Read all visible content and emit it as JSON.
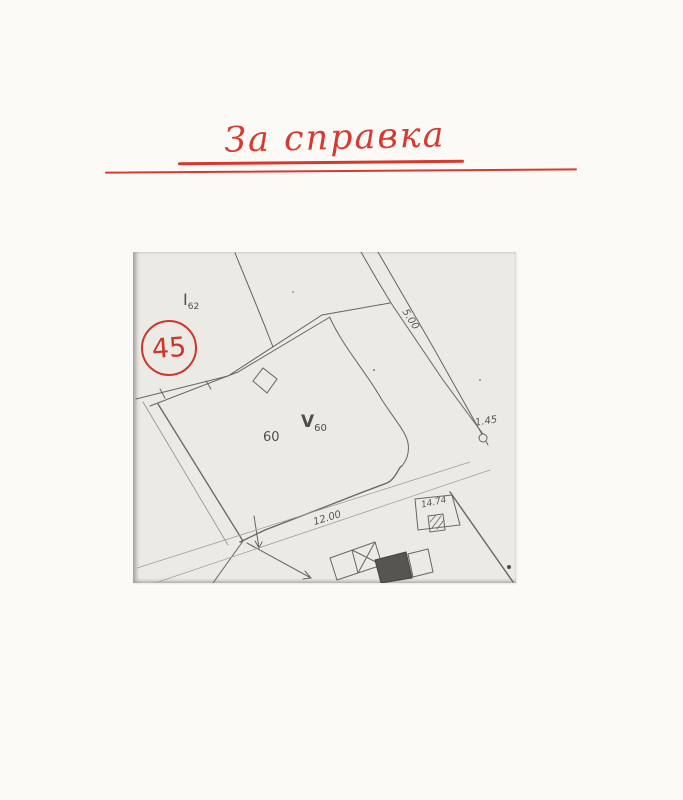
{
  "page": {
    "title": "За справка",
    "title_color": "#d63a30"
  },
  "map": {
    "stamp_number": "45",
    "labels": {
      "parcel_i_main": "I",
      "parcel_i_sub": "62",
      "parcel_60": "60",
      "parcel_v_main": "V",
      "parcel_v_sub": "60",
      "dim_road_top": "5.00",
      "dim_node": "1.45",
      "dim_road_bottom": "12.00",
      "dim_yard": "14.74"
    },
    "colors": {
      "stamp_red": "#cc362c",
      "ink": "#66655f",
      "photo_background": "#eceae5",
      "page_background": "#fbfaf6",
      "dark_building_fill": "#56554f"
    }
  }
}
